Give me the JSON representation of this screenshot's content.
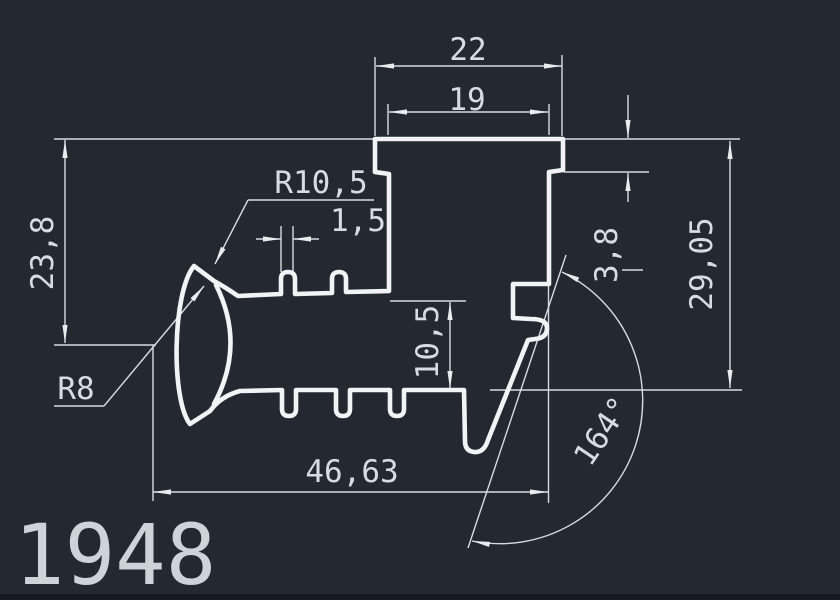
{
  "drawing": {
    "part_number": "1948",
    "type": "profile-cross-section",
    "colors": {
      "background": "#232831",
      "lines": "#f1f3f5",
      "dim_lines": "#d7dce2",
      "text": "#d7dce2"
    },
    "dimensions": {
      "top_outer_width": "22",
      "top_inner_width": "19",
      "hook_outer_radius": "R10,5",
      "tooth_width": "1,5",
      "left_height": "23,8",
      "hook_inner_radius": "R8",
      "mid_height": "10,5",
      "cap_height": "3,8",
      "right_height": "29,05",
      "bottom_width": "46,63",
      "flank_angle": "164°"
    }
  }
}
